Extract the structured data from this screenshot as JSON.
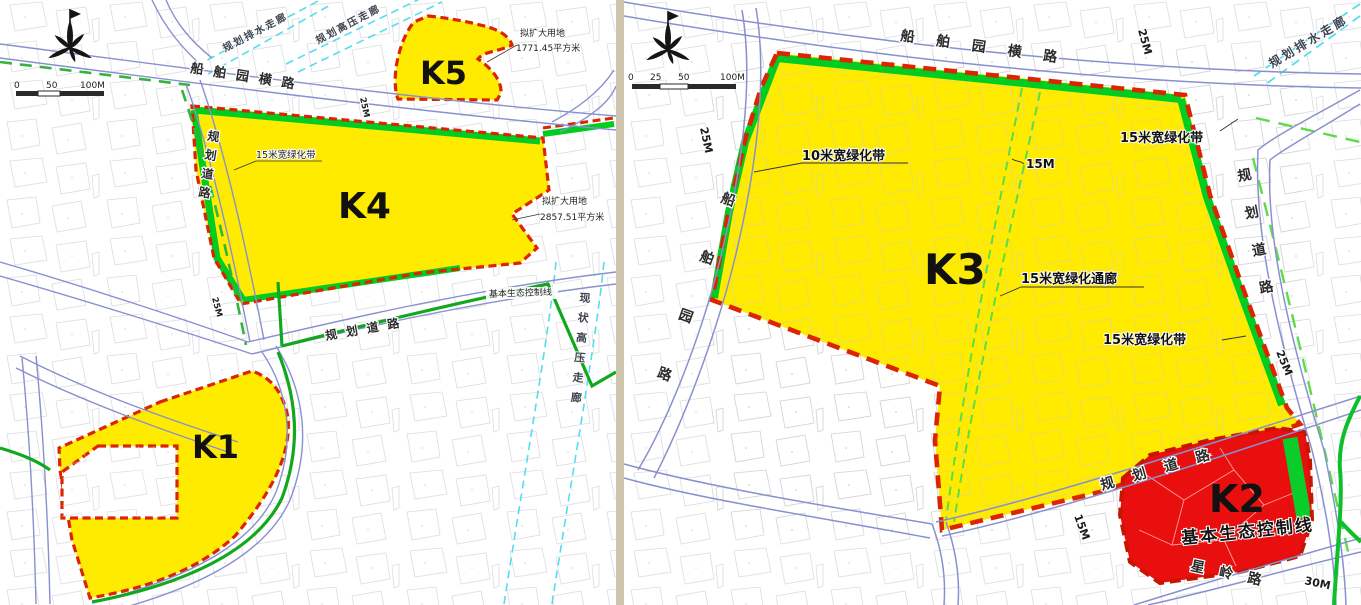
{
  "colors": {
    "zone_yellow": "#ffeb00",
    "zone_red": "#e90f0f",
    "boundary_red": "#dd2400",
    "green_band": "#00cc22",
    "eco_green": "#12a81e",
    "road_blue": "#8890cf",
    "corridor_cyan": "#55dcee",
    "dashed_green": "#33b43c",
    "light_dashed_green": "#5bdc4a",
    "divider_beige": "#cfc5ae"
  },
  "left_map": {
    "scale_bar": {
      "ticks": [
        "0",
        "50",
        "100M"
      ]
    },
    "zones": {
      "k1": "K1",
      "k4": "K4",
      "k5": "K5"
    },
    "roads": {
      "top_name": "船舶园横路",
      "top_width": "25M",
      "west_name": "规划道路",
      "west_width": "25M",
      "mid_name": "规划道路"
    },
    "corridors": {
      "drainage": "规划排水走廊",
      "hv_planned": "规划高压走廊",
      "hv_existing": "现状高压走廊"
    },
    "eco_control_line": "基本生态控制线",
    "annotations": {
      "green_belt": "15米宽绿化带",
      "k5_expansion_title": "拟扩大用地",
      "k5_expansion_area": "1771.45平方米",
      "k4_expansion_title": "拟扩大用地",
      "k4_expansion_area": "2857.51平方米"
    }
  },
  "right_map": {
    "scale_bar": {
      "ticks": [
        "0",
        "25",
        "50",
        "100M"
      ]
    },
    "zones": {
      "k2": "K2",
      "k3": "K3"
    },
    "roads": {
      "top_name": "船舶园横路",
      "top_width": "25M",
      "west_name": "船舶园路",
      "west_width": "25M",
      "east_name": "规划道路",
      "east_width": "25M",
      "southeast_name": "规划道路",
      "southeast_width": "15M",
      "xingling_name": "星岭路",
      "xingling_width": "30M"
    },
    "corridors": {
      "drainage": "规划排水走廊"
    },
    "eco_control_line": "基本生态控制线",
    "annotations": {
      "belt_10m": "10米宽绿化带",
      "corridor_15m": "15米宽绿化通廊",
      "corridor_width": "15M",
      "belt_15m_right": "15米宽绿化带",
      "belt_15m_topright": "15米宽绿化带"
    }
  }
}
